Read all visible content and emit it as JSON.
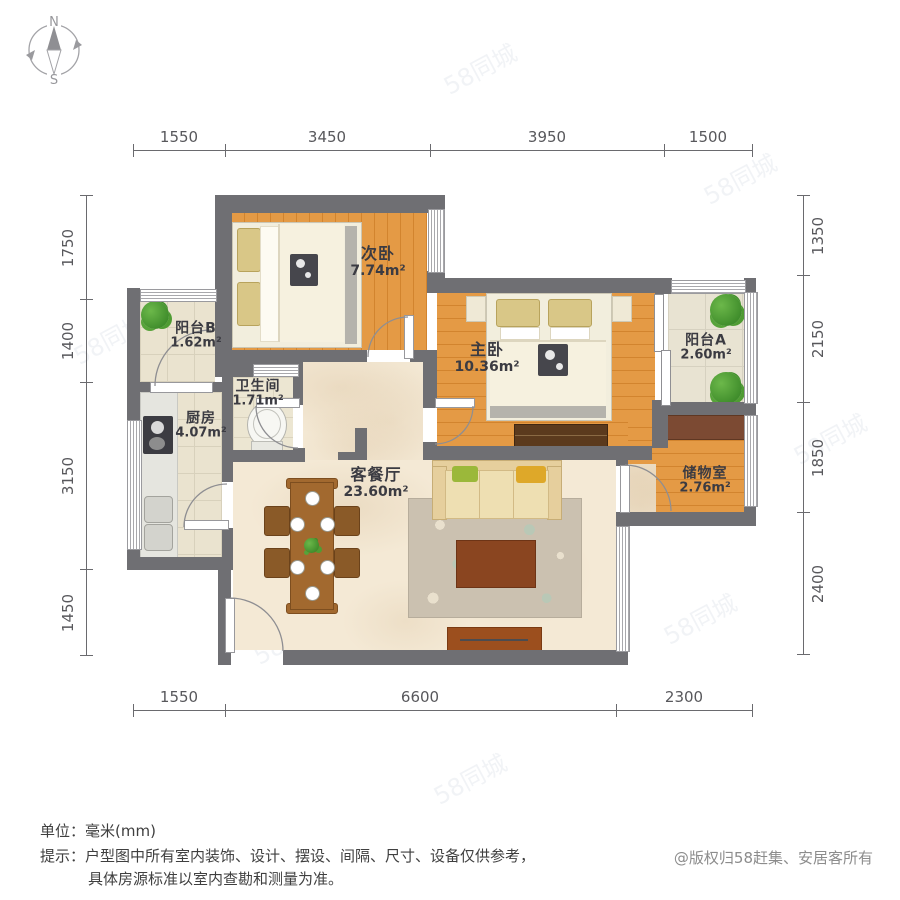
{
  "compass": {
    "north_label": "N",
    "south_label": "S"
  },
  "watermark_text": "58同城",
  "rooms": [
    {
      "name": "次卧",
      "area": "7.74m²"
    },
    {
      "name": "主卧",
      "area": "10.36m²"
    },
    {
      "name": "阳台B",
      "area": "1.62m²"
    },
    {
      "name": "卫生间",
      "area": "1.71m²"
    },
    {
      "name": "厨房",
      "area": "4.07m²"
    },
    {
      "name": "客餐厅",
      "area": "23.60m²"
    },
    {
      "name": "阳台A",
      "area": "2.60m²"
    },
    {
      "name": "储物室",
      "area": "2.76m²"
    }
  ],
  "dimensions": {
    "top": [
      "1550",
      "3450",
      "3950",
      "1500"
    ],
    "bottom": [
      "1550",
      "6600",
      "2300"
    ],
    "left": [
      "1750",
      "1400",
      "3150",
      "1450"
    ],
    "right": [
      "1350",
      "2150",
      "1850",
      "2400"
    ]
  },
  "footer": {
    "unit_label": "单位：",
    "unit_value": "毫米(mm)",
    "tip_label": "提示：",
    "tip_line1": "户型图中所有室内装饰、设计、摆设、间隔、尺寸、设备仅供参考，",
    "tip_line2": "具体房源标准以室内查勘和测量为准。",
    "copyright": "@版权归58赶集、安居客所有"
  }
}
